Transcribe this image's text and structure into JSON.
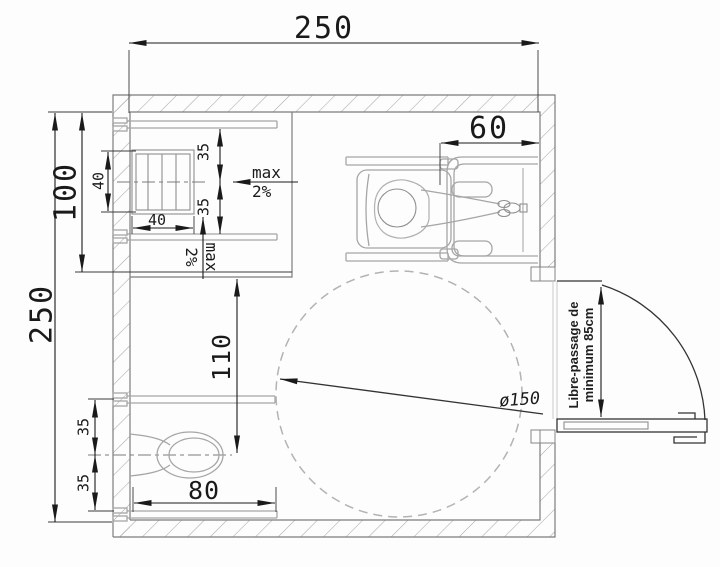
{
  "diagram": {
    "type": "floor-plan",
    "subject": "Accessible shower / WC room plan with wheelchair user, turning circle and outward opening door",
    "colors": {
      "ink": "#1a1a1a",
      "wall_outline": "#7d7d7d",
      "hatch": "#a8a8a8",
      "fixture_gray": "#a6a6a6",
      "turning_circle_gray": "#b3b3b3",
      "background": "#fdfdfd"
    }
  },
  "plan": {
    "room": {
      "width_label": "250",
      "height_label": "250"
    },
    "shower": {
      "depth_label": "100",
      "drain_width_label": "40",
      "drain_height_label": "40",
      "offset_top_label": "35",
      "offset_bottom_label": "35",
      "slope": {
        "line1": "max",
        "line2": "2%"
      },
      "slope_vertical": {
        "line1": "max",
        "line2": "2%"
      }
    },
    "washbasin": {
      "width_label": "60"
    },
    "toilet": {
      "axis_label": "110",
      "offset_top_label": "35",
      "offset_bottom_label": "35",
      "width_label": "80"
    },
    "turning_circle": {
      "diameter_label": "ø150"
    },
    "door": {
      "clearance_line1": "Libre-passage de",
      "clearance_line2": "minimum 85cm"
    }
  }
}
